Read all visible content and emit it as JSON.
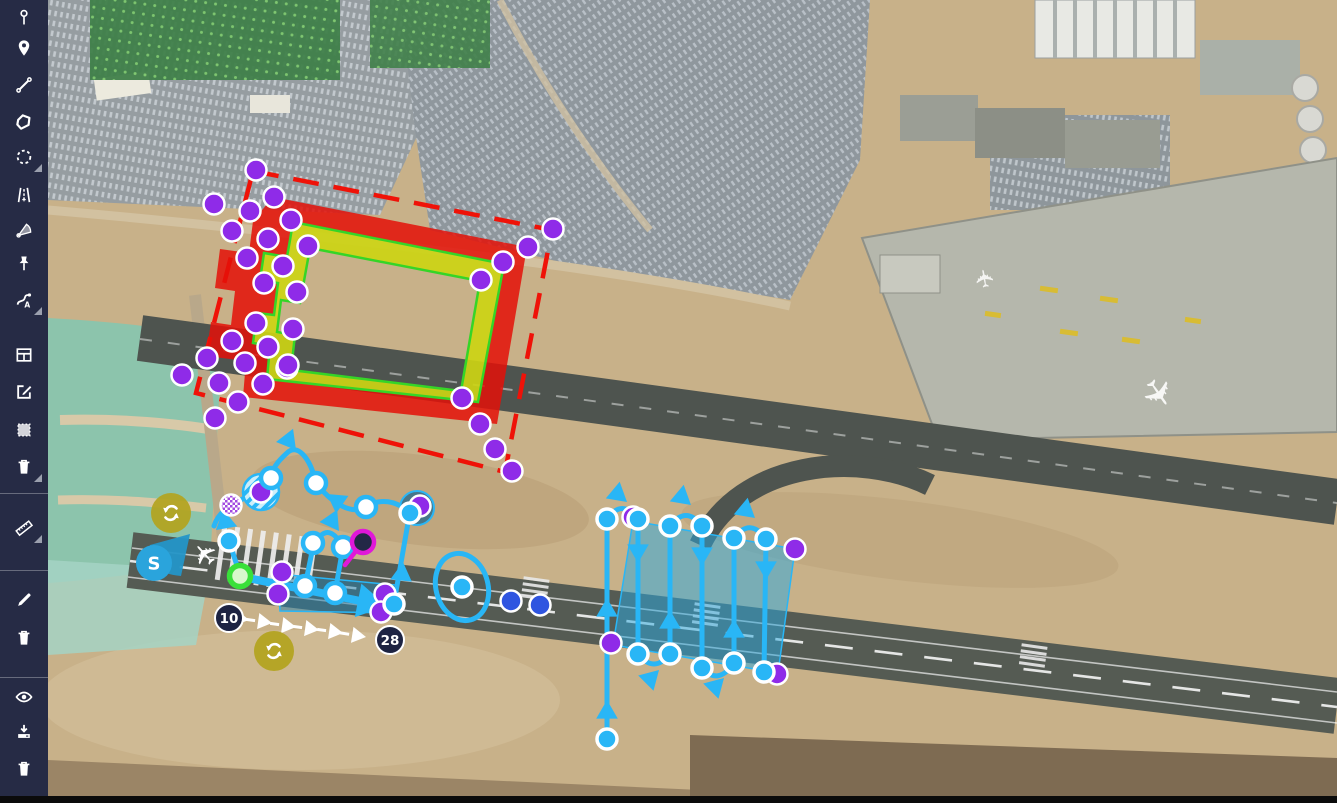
{
  "app": {
    "kind": "aerodrome-mission-planner",
    "view": "satellite-map-editor"
  },
  "colors": {
    "sidebar_bg": "#262b45",
    "icon": "#ffffff",
    "accent_cyan": "#29b6f6",
    "vertex_purple": "#8f2be8",
    "zone_red": "#e41008",
    "zone_yellow": "#ccd414",
    "zone_green_line": "#35d527",
    "label_navy": "#1d2342",
    "refresh_olive": "#b3a41f",
    "dot_blue": "#2f55e0",
    "pin_magenta": "#e018d8",
    "loiter_teal": "#25698c",
    "start_blue": "#2aa4dc"
  },
  "sidebar": {
    "tools": [
      {
        "y": 18,
        "icon": "pin-stick",
        "name": "add-pin",
        "submenu": false
      },
      {
        "y": 48,
        "icon": "map-marker",
        "name": "add-marker",
        "submenu": false
      },
      {
        "y": 85,
        "icon": "polyline",
        "name": "draw-line",
        "submenu": false
      },
      {
        "y": 122,
        "icon": "polygon",
        "name": "draw-polygon",
        "submenu": false
      },
      {
        "y": 157,
        "icon": "dashed-circle",
        "name": "draw-circle",
        "submenu": true
      },
      {
        "y": 195,
        "icon": "runway",
        "name": "draw-runway",
        "submenu": false
      },
      {
        "y": 230,
        "icon": "sector",
        "name": "draw-sector",
        "submenu": false
      },
      {
        "y": 264,
        "icon": "pushpin",
        "name": "add-pushpin",
        "submenu": false
      },
      {
        "y": 300,
        "icon": "route",
        "name": "draw-route",
        "submenu": true
      },
      {
        "y": 355,
        "icon": "table",
        "name": "open-table",
        "submenu": false
      },
      {
        "y": 392,
        "icon": "edit-square",
        "name": "edit-feature",
        "submenu": false
      },
      {
        "y": 430,
        "icon": "select-region",
        "name": "select-region",
        "submenu": false
      },
      {
        "y": 467,
        "icon": "trash",
        "name": "delete-feature",
        "submenu": true
      },
      {
        "y": 528,
        "icon": "ruler",
        "name": "measure",
        "submenu": true
      },
      {
        "y": 600,
        "icon": "pencil",
        "name": "draw-sketch",
        "submenu": false
      },
      {
        "y": 638,
        "icon": "trash",
        "name": "delete-sketch",
        "submenu": false
      },
      {
        "y": 697,
        "icon": "eye",
        "name": "toggle-visibility",
        "submenu": false
      },
      {
        "y": 732,
        "icon": "download",
        "name": "download-data",
        "submenu": false
      },
      {
        "y": 769,
        "icon": "trash",
        "name": "clear-all",
        "submenu": false
      }
    ],
    "dividers": [
      493,
      570,
      677
    ]
  },
  "labels": {
    "runway_end_left": "10",
    "runway_end_right": "28",
    "start_point": "S"
  },
  "overlays": {
    "dashed_rect_points": "253,171 552,230 505,472 196,393",
    "red_outer_d": "M273 197L527 247L497 424L243 397L246 361L206 356L211 322L231 325L235 291L215 288L220 249L249 253L253 221Z",
    "red_inner_d": "M293 222L504 264L478 402L267 379L270 346L253 343L257 313L274 315L278 283L260 280L264 253L287 257L290 240Z",
    "yellow_hole_d": "M310 248L480 281L461 391L291 370L295 335L277 332L281 300L300 303Z",
    "survey_area_points": "633,521 795,549 778,673 613,645",
    "band_points": "278,574 396,585 393,613 280,611",
    "paths": [
      {
        "d": "M410 513C396 500 380 498 366 507C350 516 330 501 316 483"
      },
      {
        "d": "M316 483C310 457 297 443 287 453C277 462 272 469 271 478"
      },
      {
        "d": "M261 492C246 497 220 506 214 526"
      },
      {
        "d": "M229 541L240 575"
      },
      {
        "d": "M305 586L313 547Q327 518 343 547L335 593"
      },
      {
        "d": "M394 603L409 517"
      },
      {
        "d": "M243 577L380 605",
        "w": 8
      },
      {
        "d": "M607 739L607 519"
      },
      {
        "d": "M638 519L638 654"
      },
      {
        "d": "M670 526L670 654"
      },
      {
        "d": "M702 526L702 668"
      },
      {
        "d": "M734 538L734 663"
      },
      {
        "d": "M766 539L764 672"
      },
      {
        "d": "M607 519Q622 498 638 519"
      },
      {
        "d": "M670 526Q686 505 702 526"
      },
      {
        "d": "M734 538Q750 517 766 539"
      },
      {
        "d": "M638 654Q654 674 670 654"
      },
      {
        "d": "M702 668Q718 686 734 663"
      }
    ],
    "arrows_cyan": [
      [
        296,
        450,
        52
      ],
      [
        327,
        494,
        215
      ],
      [
        216,
        530,
        140
      ],
      [
        339,
        531,
        55
      ],
      [
        403,
        562,
        -84
      ],
      [
        387,
        606,
        11,
        19
      ],
      [
        607,
        700,
        -90
      ],
      [
        607,
        598,
        -90
      ],
      [
        638,
        563,
        90
      ],
      [
        670,
        610,
        -90
      ],
      [
        702,
        566,
        90
      ],
      [
        734,
        619,
        -90
      ],
      [
        766,
        580,
        90
      ],
      [
        627,
        502,
        40
      ],
      [
        691,
        505,
        40
      ],
      [
        755,
        518,
        40
      ],
      [
        659,
        670,
        -45
      ],
      [
        724,
        678,
        -45
      ]
    ],
    "arrows_white": [
      [
        249,
        620,
        10
      ],
      [
        272,
        623,
        8
      ],
      [
        296,
        627,
        8
      ],
      [
        319,
        630,
        8
      ],
      [
        343,
        633,
        8
      ],
      [
        366,
        637,
        9
      ]
    ],
    "vertices_purple": [
      [
        256,
        170
      ],
      [
        274,
        197
      ],
      [
        214,
        204
      ],
      [
        250,
        211
      ],
      [
        291,
        220
      ],
      [
        232,
        231
      ],
      [
        268,
        239
      ],
      [
        308,
        246
      ],
      [
        247,
        258
      ],
      [
        283,
        266
      ],
      [
        553,
        229
      ],
      [
        528,
        247
      ],
      [
        503,
        262
      ],
      [
        481,
        280
      ],
      [
        264,
        283
      ],
      [
        297,
        292
      ],
      [
        256,
        323
      ],
      [
        293,
        329
      ],
      [
        232,
        341
      ],
      [
        268,
        347
      ],
      [
        245,
        363
      ],
      [
        287,
        368
      ],
      [
        219,
        383
      ],
      [
        263,
        384
      ],
      [
        182,
        375
      ],
      [
        207,
        358
      ],
      [
        238,
        402
      ],
      [
        215,
        418
      ],
      [
        288,
        365
      ],
      [
        462,
        398
      ],
      [
        480,
        424
      ],
      [
        495,
        449
      ],
      [
        512,
        471
      ],
      [
        282,
        572
      ],
      [
        278,
        594
      ],
      [
        385,
        594
      ],
      [
        381,
        612
      ],
      [
        420,
        506
      ],
      [
        633,
        517
      ],
      [
        795,
        549
      ],
      [
        611,
        643
      ],
      [
        777,
        674
      ],
      [
        261,
        492
      ]
    ],
    "waypoints_outlined": [
      [
        271,
        478
      ],
      [
        316,
        483
      ],
      [
        366,
        507
      ],
      [
        313,
        543
      ],
      [
        343,
        547
      ],
      [
        305,
        586
      ],
      [
        335,
        593
      ]
    ],
    "waypoints_filled": [
      [
        229,
        541
      ],
      [
        410,
        513
      ],
      [
        462,
        587
      ],
      [
        394,
        604
      ],
      [
        607,
        519
      ],
      [
        638,
        519
      ],
      [
        670,
        526
      ],
      [
        702,
        526
      ],
      [
        734,
        538
      ],
      [
        766,
        539
      ],
      [
        638,
        654
      ],
      [
        670,
        654
      ],
      [
        702,
        668
      ],
      [
        734,
        663
      ],
      [
        764,
        672
      ],
      [
        607,
        739
      ]
    ],
    "blue_dots": [
      [
        511,
        601
      ],
      [
        540,
        605
      ]
    ],
    "green_start_dot": [
      240,
      576
    ],
    "magenta_pin": {
      "cx": 363,
      "cy": 542,
      "stem": [
        345,
        565,
        356,
        551
      ]
    },
    "ellipse": {
      "cx": 462,
      "cy": 587,
      "rx": 26,
      "ry": 34,
      "rot": -15
    },
    "loiter_circle": {
      "cx": 417,
      "cy": 508,
      "r": 17
    },
    "hatched_circle": {
      "cx": 261,
      "cy": 492,
      "r": 18
    },
    "checker_circle": {
      "cx": 231,
      "cy": 505,
      "r": 10.5
    },
    "wedge_d": "M190 534L150 545Q146 573 181 576Z",
    "refresh_buttons": [
      [
        171,
        513
      ],
      [
        274,
        651
      ]
    ],
    "runway_labels": [
      {
        "key": "runway_end_left",
        "x": 229,
        "y": 618,
        "r": 14
      },
      {
        "key": "runway_end_right",
        "x": 390,
        "y": 640,
        "r": 14
      }
    ],
    "start_marker": {
      "key": "start_point",
      "x": 154,
      "y": 563,
      "r": 18
    },
    "plane_marker": {
      "x": 213,
      "y": 547
    }
  }
}
